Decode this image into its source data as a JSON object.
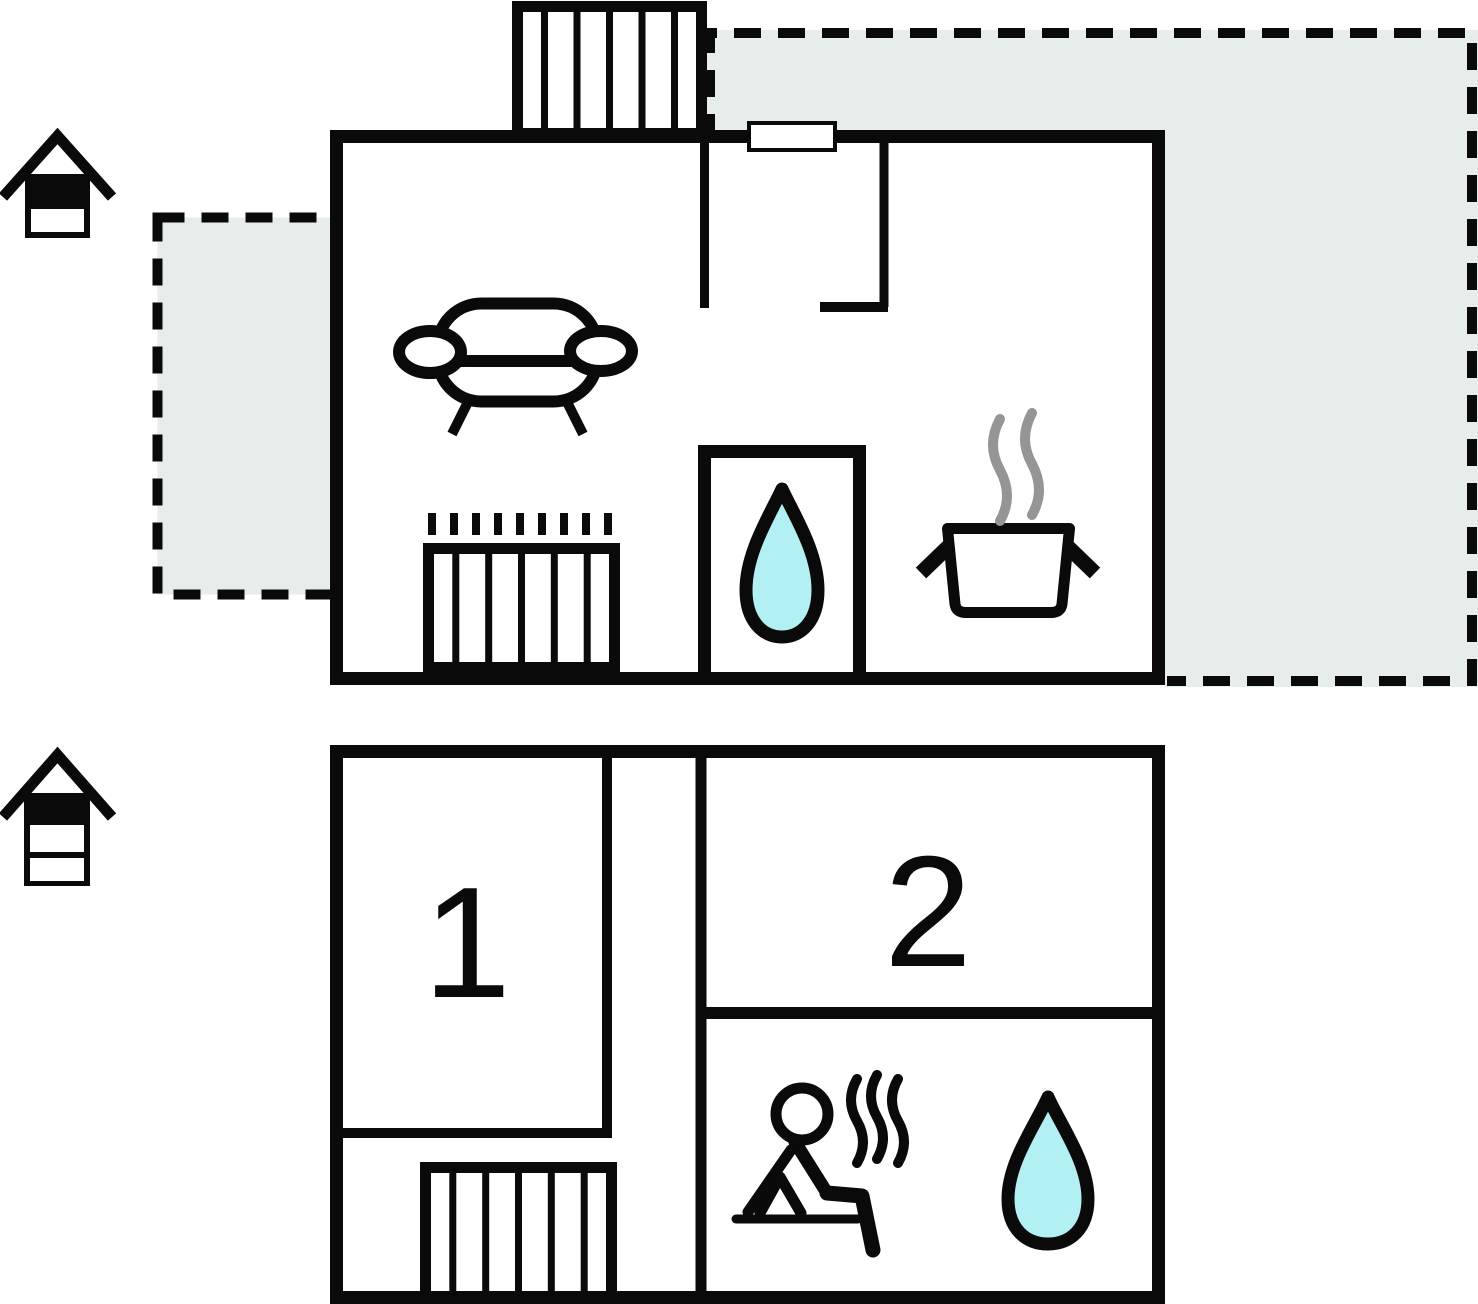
{
  "diagram_type": "house-floor-plan",
  "colors": {
    "line": "#0a0a0a",
    "terrace_fill": "#e7edeb",
    "water_drop_fill": "#b3f0f3",
    "steam": "#959595",
    "background": "#ffffff"
  },
  "upper_floor": {
    "indicator_icon": "house-cross-section-top-level-filled",
    "icons": [
      "staircase-icon",
      "entrance-door",
      "sofa-icon",
      "radiator-icon",
      "water-drop-icon",
      "cooking-pot-icon",
      "steam-icon"
    ],
    "terraces": [
      "terrace-left",
      "terrace-right"
    ]
  },
  "lower_floor": {
    "indicator_icon": "house-cross-section-three-levels-top-filled",
    "rooms": [
      {
        "label": "1"
      },
      {
        "label": "2"
      }
    ],
    "icons": [
      "staircase-icon",
      "sauna-person-icon",
      "heat-waves-icon",
      "water-drop-icon"
    ]
  }
}
